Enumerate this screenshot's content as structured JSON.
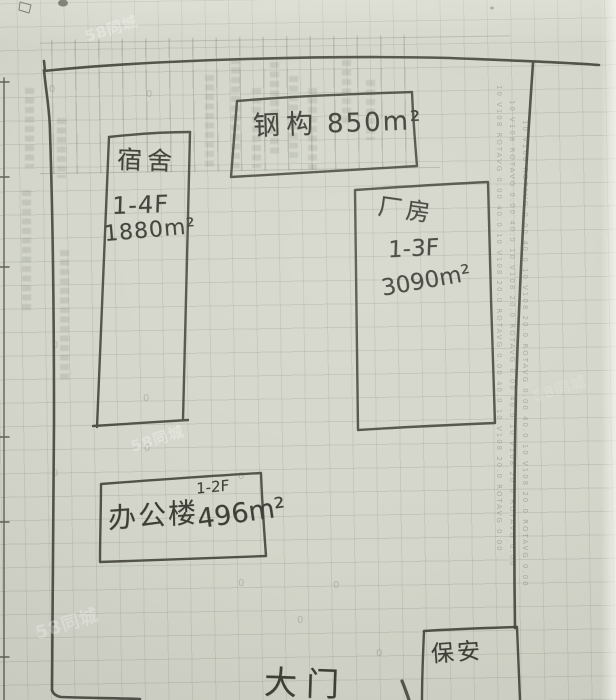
{
  "document": {
    "type": "hand-drawn factory site plan sketched in pencil on graph paper"
  },
  "buildings": {
    "steel": {
      "name": "钢构",
      "area": "850m²"
    },
    "dormitory": {
      "name": "宿舍",
      "floors": "1-4F",
      "area": "1880m²"
    },
    "factory": {
      "name": "厂房",
      "floors": "1-3F",
      "area": "3090m²"
    },
    "office": {
      "name": "办公楼",
      "floors": "1-2F",
      "area": "496m²"
    },
    "guard": {
      "name": "保安"
    }
  },
  "gate": {
    "label": "大门"
  },
  "watermark": {
    "text": "58同城"
  },
  "bleed": {
    "zero": "0",
    "right_column": "10 V108  ROTAVG  0.00  40.0  10 V108  20.0  ROTAVG  0.00  40.0  10 V108  20.0  ROTAVG  0.00"
  },
  "colors": {
    "paper": "#d4d6cb",
    "grid": "#a9ae9e",
    "pencil": "#46463f",
    "watermark": "#ffffff"
  }
}
